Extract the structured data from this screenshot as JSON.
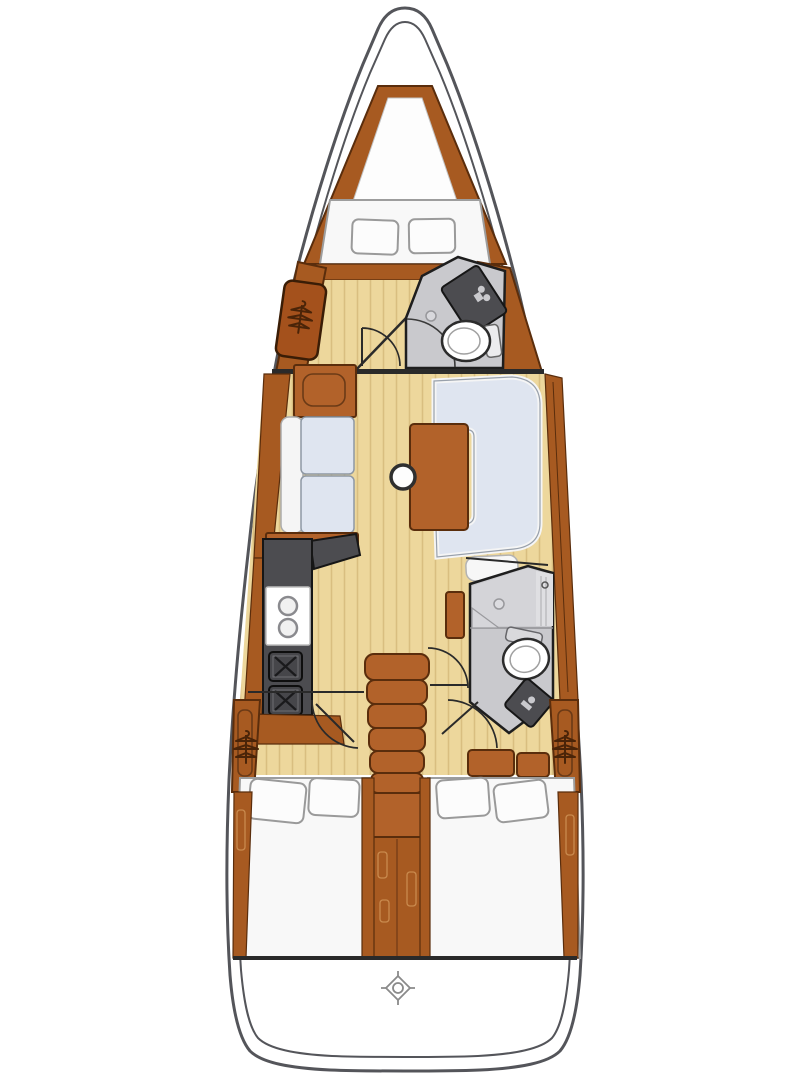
{
  "meta": {
    "description": "Top-down interior layout floor plan of a sailing yacht, bow at top",
    "canvas": {
      "width": 810,
      "height": 1080
    }
  },
  "palette": {
    "background": "#ffffff",
    "hull_line": "#54555a",
    "wood": "#a75a21",
    "wood_mid": "#b2622a",
    "wood_outline": "#5a2d0c",
    "wood_detail": "#c98a4e",
    "floor": "#edd79c",
    "floor_stripe": "#d9be80",
    "berth": "#f8f8f8",
    "berth_outline": "#9d9d9d",
    "cushion": "#dfe5f0",
    "cushion_outline": "#8e98a4",
    "piping": "#f5f5f5",
    "head_floor": "#c9c9cd",
    "shower_floor": "#d4d4d8",
    "head_outline": "#1e1e1e",
    "fixture": "#4c4c50",
    "fixture_outline": "#161616",
    "fixture_glyph": "#c9c9cd",
    "toilet": "#ffffff",
    "toilet_outline": "#2c2c2c",
    "line_dark": "#2a2a2a",
    "compass": "#8a8a8a"
  },
  "regions": {
    "hull": {
      "label": "Sailboat hull outline"
    },
    "anchor_locker": {
      "label": "Forepeak anchor locker"
    },
    "forward_cabin": {
      "label": "Forward cabin with V-berth and hanging locker"
    },
    "forward_head": {
      "label": "Forward head with sink, toilet and shower"
    },
    "salon": {
      "label": "Salon with port settee, U-shaped settee, table and mast post"
    },
    "galley": {
      "label": "Port galley with double sink and two-burner stove"
    },
    "companionway": {
      "label": "Companionway stairs and engine compartment"
    },
    "aft_head": {
      "label": "Aft head with shower, toilet and sink"
    },
    "port_aft_cabin": {
      "label": "Port aft cabin with double berth"
    },
    "starboard_aft_cabin": {
      "label": "Starboard aft cabin with double berth"
    },
    "transom": {
      "label": "Transom and swim platform with centre marker"
    }
  },
  "icons": {
    "hanger": "clothes-hanger symbol marking a hanging locker",
    "burner": "stove burner marked with an X",
    "sink_basin": "round sink basin",
    "drain": "shower drain",
    "mast": "mast compression post",
    "compass": "centre-point marker on transom"
  }
}
